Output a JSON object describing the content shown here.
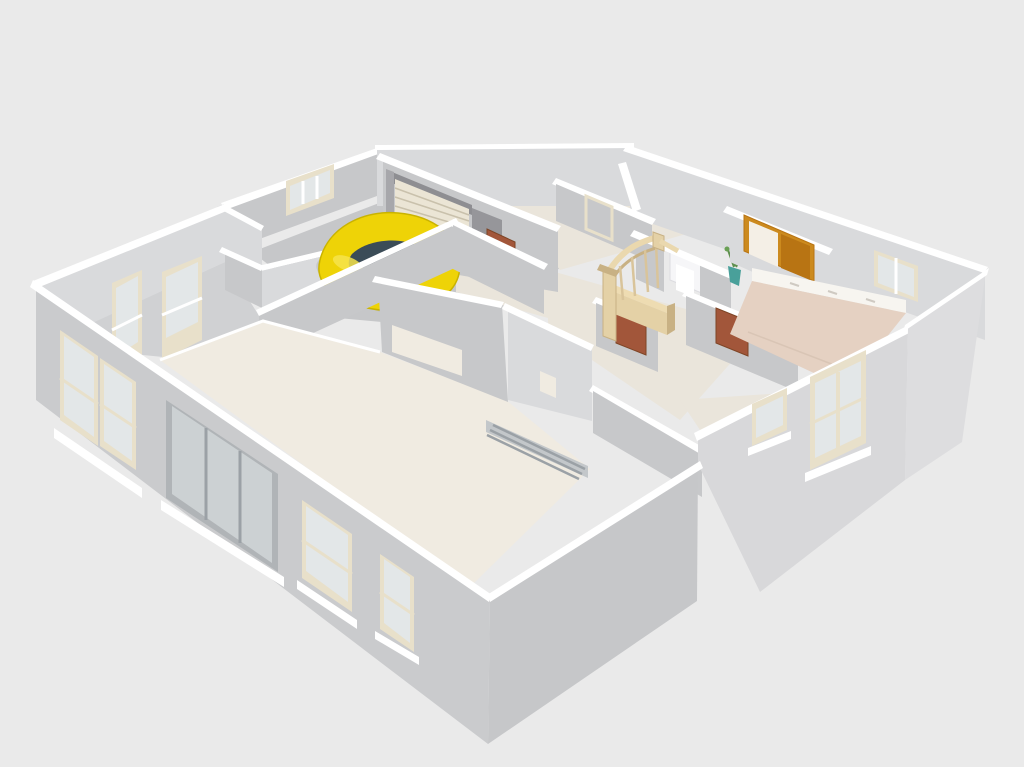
{
  "scene": {
    "kind": "3d-floor-plan-perspective-view",
    "background": "#eaeaea",
    "objects": [
      {
        "name": "house-shell",
        "walls": "light-gray",
        "wall_tops": "white"
      },
      {
        "name": "garage-car",
        "kind": "compact-beetle-car",
        "body_color": "#eed307",
        "glass_color": "#3b4c57"
      },
      {
        "name": "garage-sectional-door",
        "color": "#ebe5d5"
      },
      {
        "name": "staircase-with-railing",
        "color": "#e4d1a6"
      },
      {
        "name": "interior-doors",
        "count": 4,
        "color": "#a2563a"
      },
      {
        "name": "wardrobe-double-door",
        "frame_color": "#cc8a1e"
      },
      {
        "name": "potted-plant",
        "pot_color": "#49a09a",
        "leaf_color": "#5f8f4e"
      },
      {
        "name": "living-room-floor",
        "color": "#f0ebe1"
      },
      {
        "name": "bedroom-floor",
        "color": "#e5d1c2"
      },
      {
        "name": "windows",
        "frame_color": "#e8e0ca"
      },
      {
        "name": "sliding-glass-door",
        "frame_color": "#b0b4b7"
      }
    ]
  },
  "colors": {
    "bg": "#eaeaea",
    "wallTop": "#ffffff",
    "wallA": "#cacbcd",
    "wallB": "#d8d8da",
    "wallC": "#c7c8ca",
    "wallC2": "#c6c7c9",
    "wallD": "#d9dadc",
    "wallE2": "#dddddf",
    "floorBeige": "#f0ebe1",
    "floorBeige2": "#eae5db",
    "floorGray": "#c6c7c9",
    "floorGray2": "#d0d1d3",
    "floorPink": "#e5d1c2",
    "stripWhite": "#f7f5f0",
    "frameCream": "#e8e0ca",
    "glass": "#e3e7e8",
    "glassCool": "#ccd1d3",
    "doorBrown": "#a2563a",
    "doorBrownDk": "#7e4526",
    "amber": "#cc8a1e",
    "amberDk": "#b87413",
    "amberLight": "#f4efe6",
    "wood": "#e4d1a6",
    "woodLight": "#eedcb2",
    "woodDark": "#c8b184",
    "railLight": "#ead8ae",
    "balusterTan": "#d9c49a",
    "carYellow": "#eed307",
    "carYellowDk": "#c9b300",
    "carGlass": "#3b4c57",
    "carHighlight": "#f6e34b",
    "shadowGray": "#b4b5b7",
    "headerDark": "#8e8e92",
    "jambGray": "#a7a7ab",
    "darkOpening": "#96969a",
    "slatCream": "#ebe5d5",
    "slatLineCol": "#c9c1ac",
    "metalFrame": "#b0b4b7",
    "metal": "#9ba1a6",
    "trackBand": "#c3c7ca",
    "fixtureWhite": "#f6f6f8",
    "plantPot": "#49a09a",
    "plantLeaf": "#5f8f4e",
    "plantLeafLight": "#6aa055",
    "handleTick": "#cfcac2",
    "pinkSeam": "#d9c5b5"
  }
}
